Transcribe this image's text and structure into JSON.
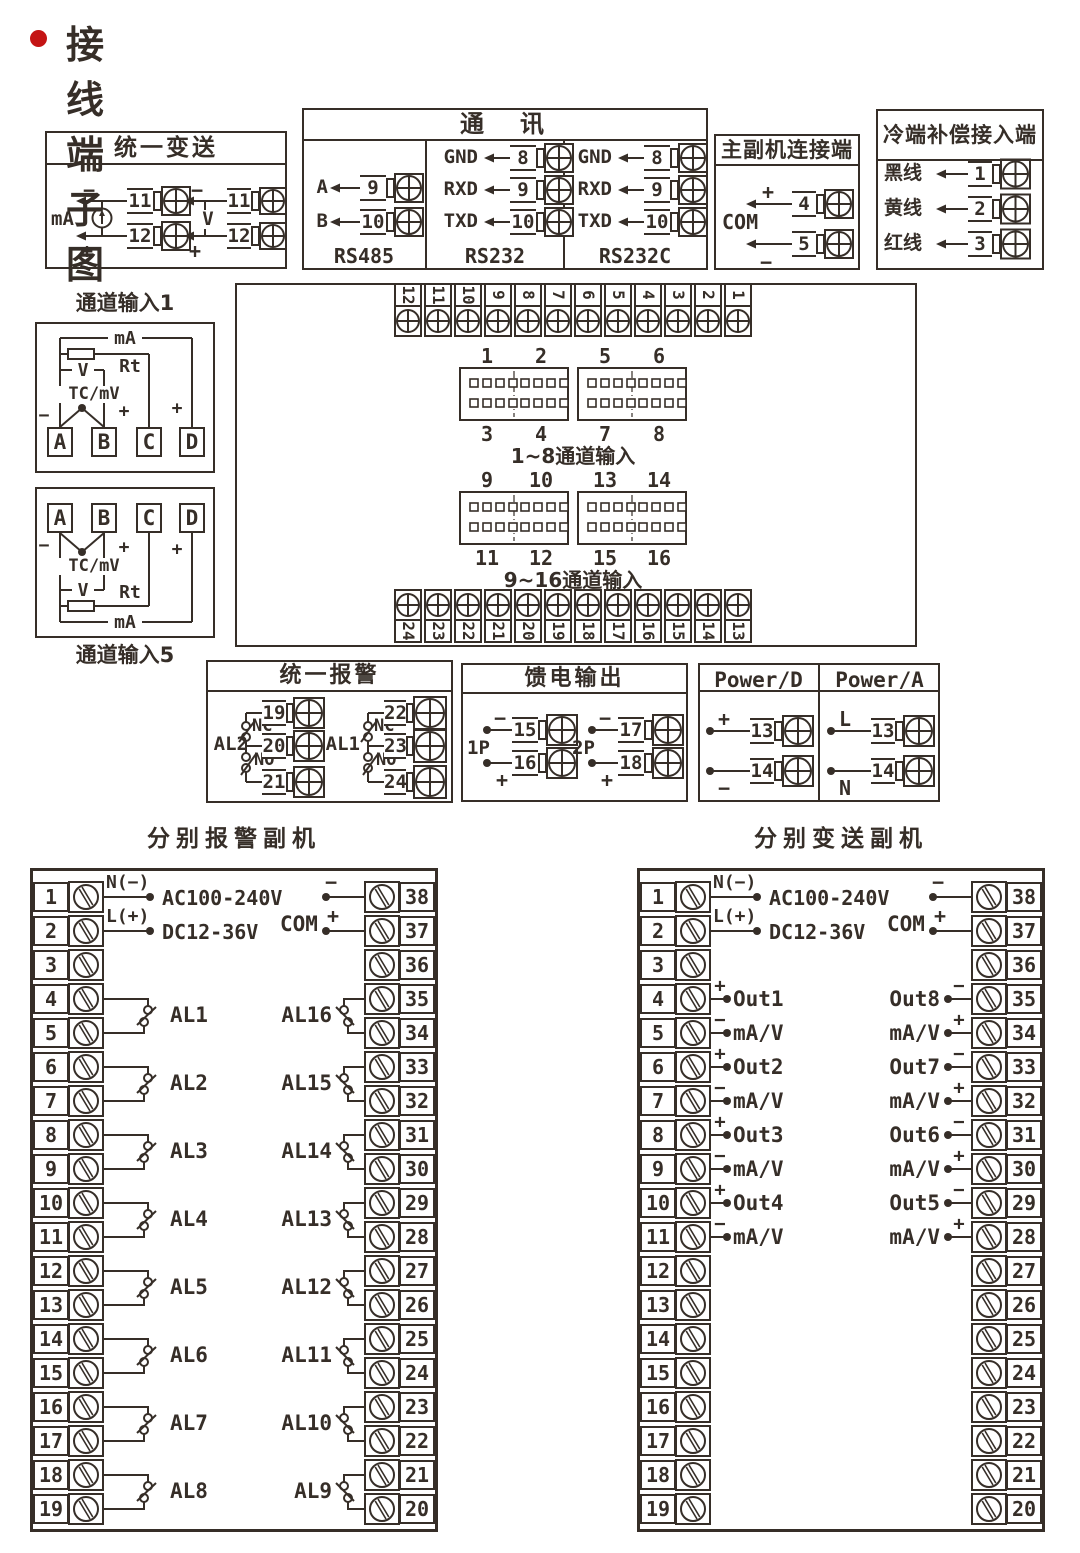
{
  "page": {
    "title": "接线端子图"
  },
  "colors": {
    "accent": "#c41414",
    "line": "#362e28"
  },
  "boxes": {
    "unified_transmit": {
      "title": "统一变送",
      "groups": [
        {
          "label": "mA",
          "top_sign": "−",
          "bottom_sign": "+",
          "terminals": [
            "11",
            "12"
          ]
        },
        {
          "label": "V",
          "top_sign": "−",
          "bottom_sign": "+",
          "terminals": [
            "11",
            "12"
          ]
        }
      ]
    },
    "comm": {
      "title": "通　讯",
      "columns": [
        {
          "footer": "RS485",
          "rows": [
            {
              "label": "A",
              "terminal": "9"
            },
            {
              "label": "B",
              "terminal": "10"
            }
          ]
        },
        {
          "footer": "RS232",
          "rows": [
            {
              "label": "GND",
              "terminal": "8"
            },
            {
              "label": "RXD",
              "terminal": "9"
            },
            {
              "label": "TXD",
              "terminal": "10"
            }
          ]
        },
        {
          "footer": "RS232C",
          "rows": [
            {
              "label": "GND",
              "terminal": "8"
            },
            {
              "label": "RXD",
              "terminal": "9"
            },
            {
              "label": "TXD",
              "terminal": "10"
            }
          ]
        }
      ]
    },
    "master_slave": {
      "title": "主副机连接端",
      "com": "COM",
      "rows": [
        {
          "sign": "+",
          "terminal": "4"
        },
        {
          "sign": "−",
          "terminal": "5"
        }
      ]
    },
    "cold_comp": {
      "title": "冷端补偿接入端",
      "rows": [
        {
          "label": "黑线",
          "terminal": "1"
        },
        {
          "label": "黄线",
          "terminal": "2"
        },
        {
          "label": "红线",
          "terminal": "3"
        }
      ]
    },
    "channel1": {
      "caption": "通道输入1",
      "ma": "mA",
      "rt": "Rt",
      "v": "V",
      "tc": "TC/mV",
      "neg": "−",
      "pos": "+",
      "pos2": "+",
      "terminals": [
        "A",
        "B",
        "C",
        "D"
      ]
    },
    "channel5": {
      "caption": "通道输入5",
      "ma": "mA",
      "rt": "Rt",
      "v": "V",
      "tc": "TC/mV",
      "neg": "−",
      "pos": "+",
      "pos2": "+",
      "terminals": [
        "A",
        "B",
        "C",
        "D"
      ]
    },
    "center": {
      "top_strip": [
        "12",
        "11",
        "10",
        "9",
        "8",
        "7",
        "6",
        "5",
        "4",
        "3",
        "2",
        "1"
      ],
      "bottom_strip": [
        "24",
        "23",
        "22",
        "21",
        "20",
        "19",
        "18",
        "17",
        "16",
        "15",
        "14",
        "13"
      ],
      "groups": [
        {
          "top": [
            "1",
            "2",
            "5",
            "6"
          ],
          "bottom": [
            "3",
            "4",
            "7",
            "8"
          ],
          "caption": "1~8通道输入"
        },
        {
          "top": [
            "9",
            "10",
            "13",
            "14"
          ],
          "bottom": [
            "11",
            "12",
            "15",
            "16"
          ],
          "caption": "9~16通道输入"
        }
      ]
    },
    "unified_alarm": {
      "title": "统一报警",
      "relays": [
        {
          "name": "AL2",
          "nc": "NC",
          "no": "NO",
          "terminals": [
            "19",
            "20",
            "21"
          ]
        },
        {
          "name": "AL1",
          "nc": "NC",
          "no": "NO",
          "terminals": [
            "22",
            "23",
            "24"
          ]
        }
      ]
    },
    "feed_output": {
      "title": "馈电输出",
      "groups": [
        {
          "name": "1P",
          "rows": [
            {
              "sign": "−",
              "terminal": "15"
            },
            {
              "sign": "+",
              "terminal": "16"
            }
          ]
        },
        {
          "name": "2P",
          "rows": [
            {
              "sign": "−",
              "terminal": "17"
            },
            {
              "sign": "+",
              "terminal": "18"
            }
          ]
        }
      ]
    },
    "power": {
      "columns": [
        {
          "title": "Power/D",
          "rows": [
            {
              "sign": "+",
              "terminal": "13"
            },
            {
              "sign": "−",
              "terminal": "14"
            }
          ]
        },
        {
          "title": "Power/A",
          "rows": [
            {
              "sign": "L",
              "terminal": "13"
            },
            {
              "sign": "N",
              "terminal": "14"
            }
          ]
        }
      ]
    }
  },
  "panels": {
    "alarm_slave": {
      "title": "分别报警副机",
      "supply": {
        "n": "N(−)",
        "l": "L(+)",
        "ac": "AC100-240V",
        "dc": "DC12-36V"
      },
      "com": {
        "label": "COM",
        "neg": "−",
        "pos": "+",
        "neg_terminal": "38",
        "pos_terminal": "37"
      },
      "left_terminals": [
        "1",
        "2",
        "3",
        "4",
        "5",
        "6",
        "7",
        "8",
        "9",
        "10",
        "11",
        "12",
        "13",
        "14",
        "15",
        "16",
        "17",
        "18",
        "19"
      ],
      "right_terminals": [
        "38",
        "37",
        "36",
        "35",
        "34",
        "33",
        "32",
        "31",
        "30",
        "29",
        "28",
        "27",
        "26",
        "25",
        "24",
        "23",
        "22",
        "21",
        "20"
      ],
      "left_relays": [
        "AL1",
        "AL2",
        "AL3",
        "AL4",
        "AL5",
        "AL6",
        "AL7",
        "AL8"
      ],
      "right_relays": [
        "AL16",
        "AL15",
        "AL14",
        "AL13",
        "AL12",
        "AL11",
        "AL10",
        "AL9"
      ]
    },
    "transmit_slave": {
      "title": "分别变送副机",
      "supply": {
        "n": "N(−)",
        "l": "L(+)",
        "ac": "AC100-240V",
        "dc": "DC12-36V"
      },
      "com": {
        "label": "COM",
        "neg": "−",
        "pos": "+",
        "neg_terminal": "38",
        "pos_terminal": "37"
      },
      "left_terminals": [
        "1",
        "2",
        "3",
        "4",
        "5",
        "6",
        "7",
        "8",
        "9",
        "10",
        "11",
        "12",
        "13",
        "14",
        "15",
        "16",
        "17",
        "18",
        "19"
      ],
      "right_terminals": [
        "38",
        "37",
        "36",
        "35",
        "34",
        "33",
        "32",
        "31",
        "30",
        "29",
        "28",
        "27",
        "26",
        "25",
        "24",
        "23",
        "22",
        "21",
        "20"
      ],
      "left_outputs": [
        {
          "sign": "+",
          "label": "Out1"
        },
        {
          "sign": "−",
          "label": "mA/V"
        },
        {
          "sign": "+",
          "label": "Out2"
        },
        {
          "sign": "−",
          "label": "mA/V"
        },
        {
          "sign": "+",
          "label": "Out3"
        },
        {
          "sign": "−",
          "label": "mA/V"
        },
        {
          "sign": "+",
          "label": "Out4"
        },
        {
          "sign": "−",
          "label": "mA/V"
        }
      ],
      "right_outputs": [
        {
          "sign": "−",
          "label": "Out8"
        },
        {
          "sign": "+",
          "label": "mA/V"
        },
        {
          "sign": "−",
          "label": "Out7"
        },
        {
          "sign": "+",
          "label": "mA/V"
        },
        {
          "sign": "−",
          "label": "Out6"
        },
        {
          "sign": "+",
          "label": "mA/V"
        },
        {
          "sign": "−",
          "label": "Out5"
        },
        {
          "sign": "+",
          "label": "mA/V"
        }
      ]
    }
  }
}
